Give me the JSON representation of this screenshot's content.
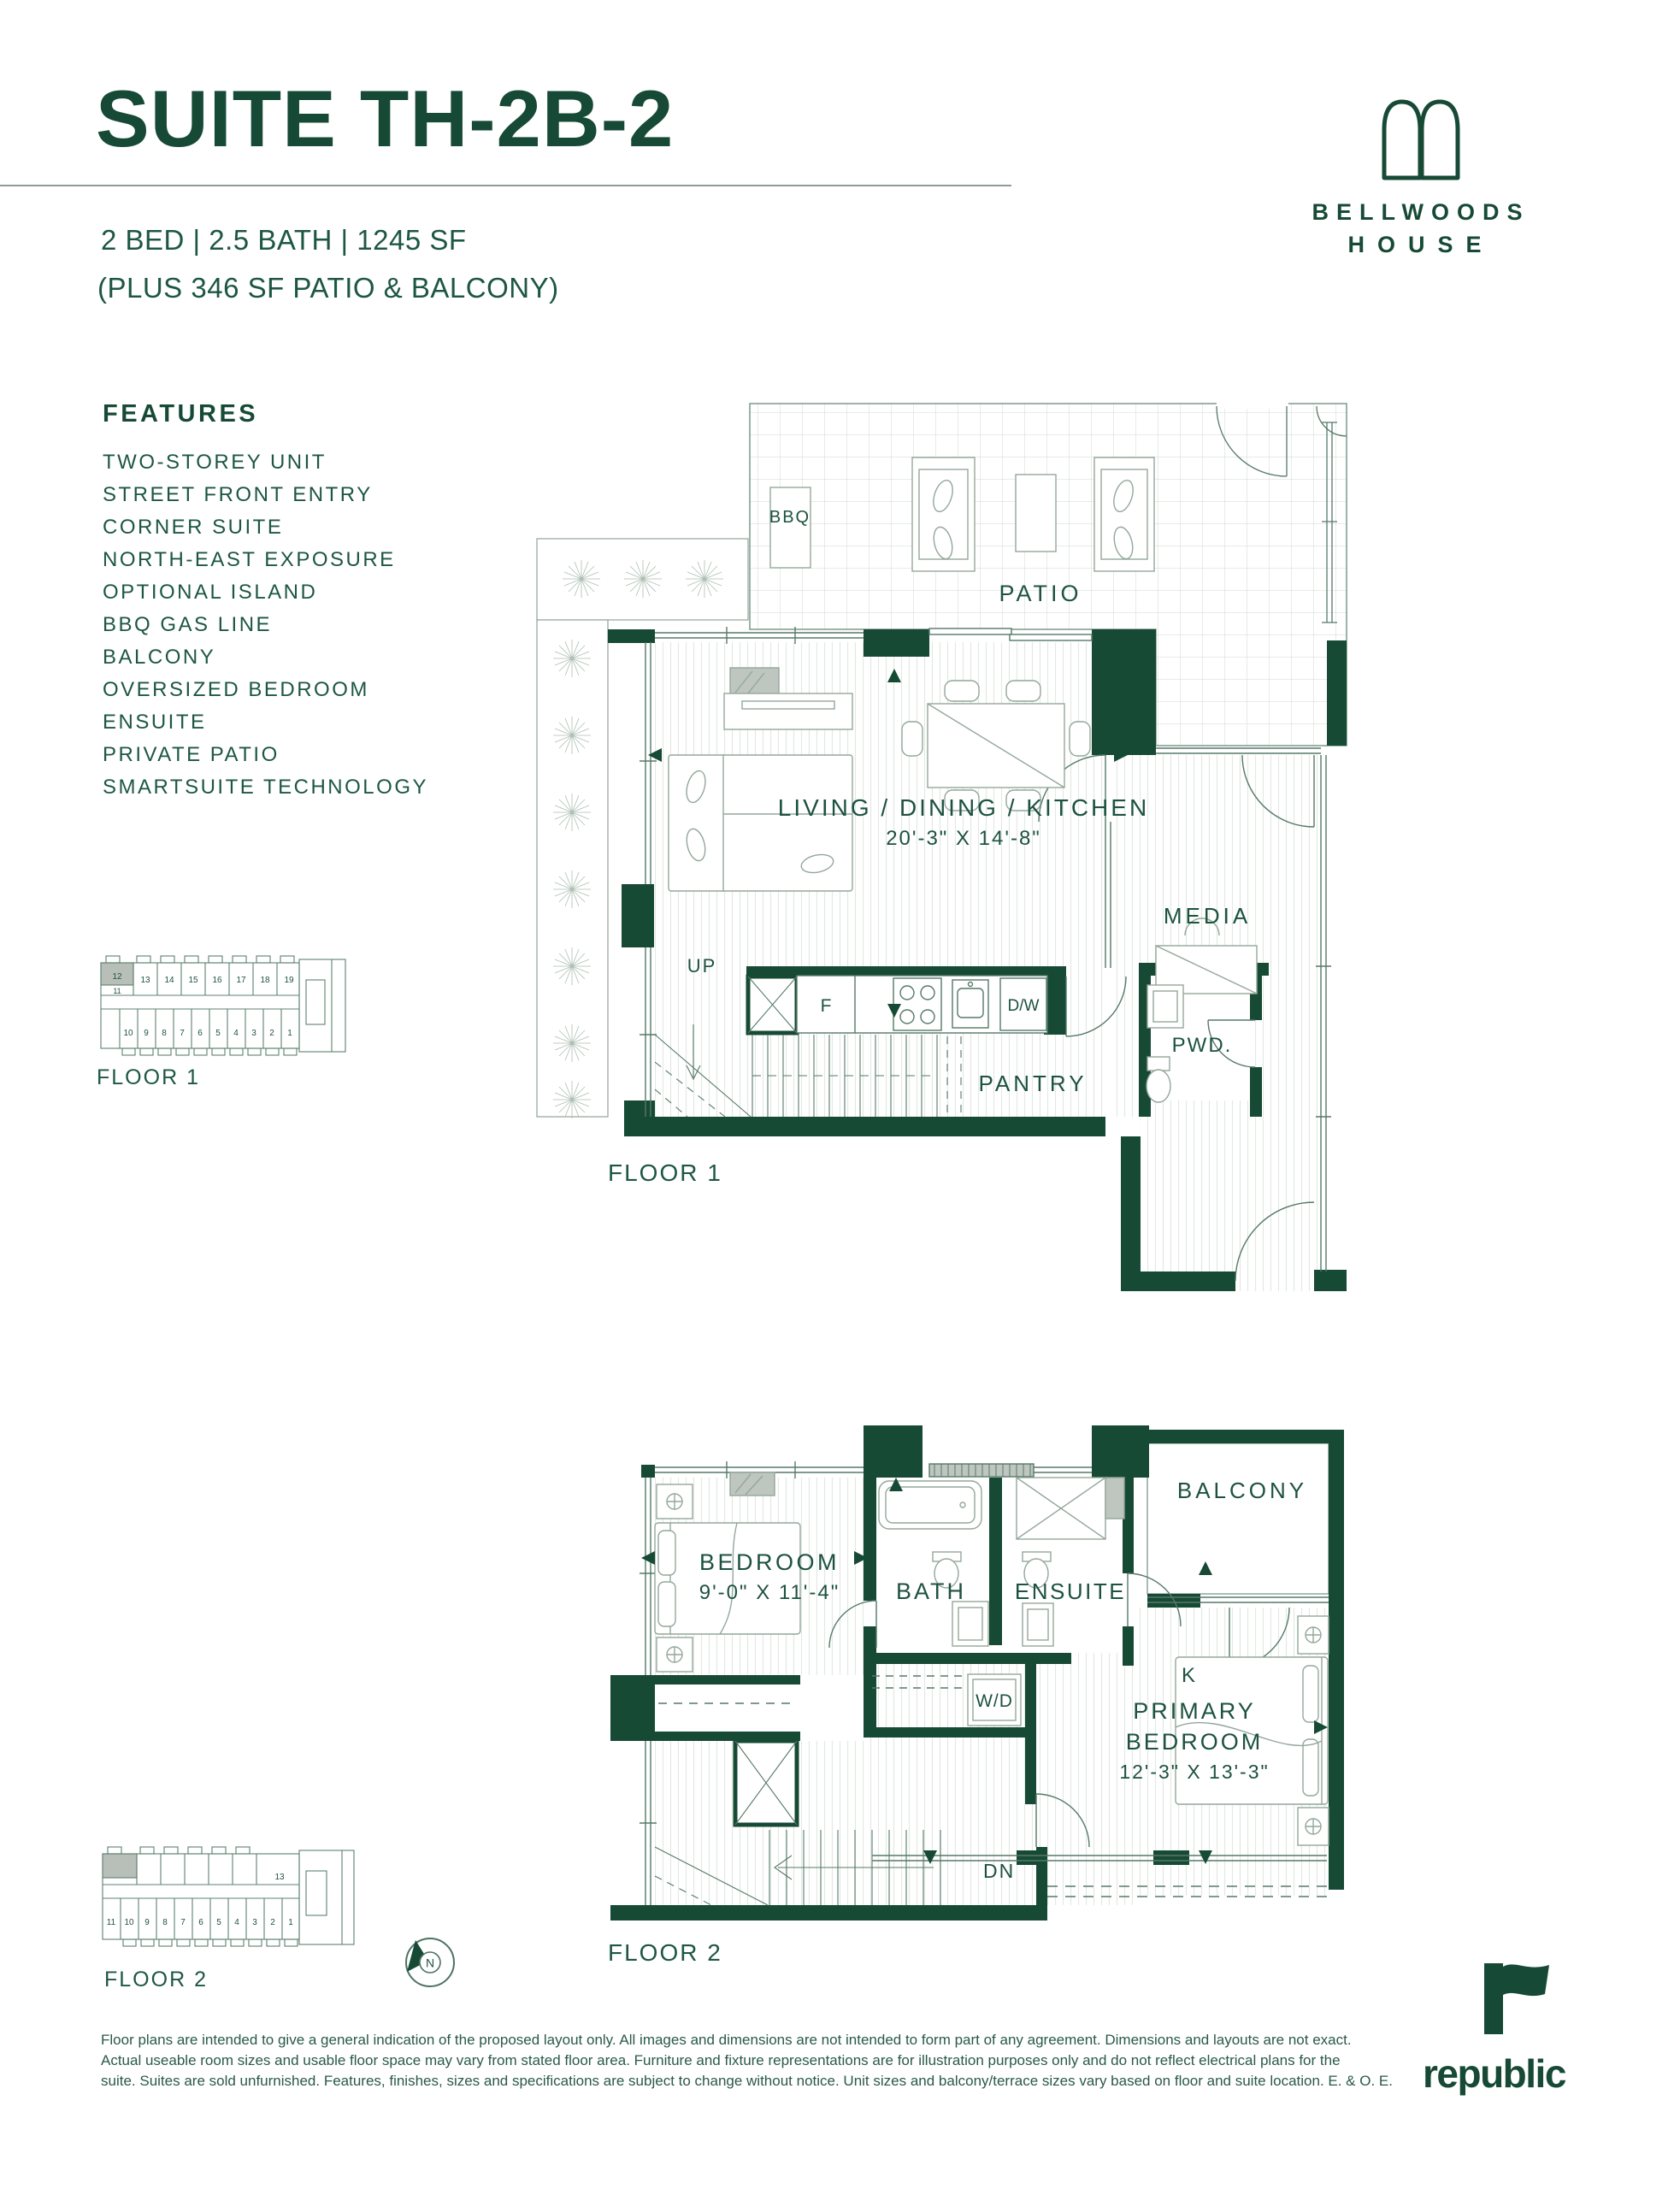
{
  "page": {
    "background": "#ffffff",
    "accent_green": "#174a35"
  },
  "header": {
    "suite_title": "SUITE TH-2B-2",
    "specs_line": "2 BED | 2.5 BATH | 1245 SF",
    "specs_extra": "(PLUS 346 SF PATIO & BALCONY)"
  },
  "brand": {
    "logo_icon": "double-arch-icon",
    "line1": "BELLWOODS",
    "line2": "HOUSE"
  },
  "features": {
    "heading": "FEATURES",
    "items": [
      "TWO-STOREY UNIT",
      "STREET FRONT ENTRY",
      "CORNER SUITE",
      "NORTH-EAST EXPOSURE",
      "OPTIONAL ISLAND",
      "BBQ GAS LINE",
      "BALCONY",
      "OVERSIZED BEDROOM",
      "ENSUITE",
      "PRIVATE PATIO",
      "SMARTSUITE TECHNOLOGY"
    ]
  },
  "floor1": {
    "plan_label": "FLOOR 1",
    "key_label": "FLOOR 1",
    "rooms": {
      "patio": "PATIO",
      "bbq": "BBQ",
      "living": "LIVING / DINING / KITCHEN",
      "living_dims": "20'-3\" X 14'-8\"",
      "media": "MEDIA",
      "powder": "PWD.",
      "pantry": "PANTRY",
      "up": "UP",
      "fridge": "F",
      "dishwasher": "D/W"
    },
    "key_units_top": [
      "12",
      "13",
      "14",
      "15",
      "16",
      "17",
      "18",
      "19"
    ],
    "key_unit_mid": "11",
    "key_units_bottom": [
      "10",
      "9",
      "8",
      "7",
      "6",
      "5",
      "4",
      "3",
      "2",
      "1"
    ],
    "highlighted_unit": "12"
  },
  "floor2": {
    "plan_label": "FLOOR 2",
    "key_label": "FLOOR 2",
    "rooms": {
      "balcony": "BALCONY",
      "bedroom": "BEDROOM",
      "bedroom_dims": "9'-0\" X 11'-4\"",
      "bath": "BATH",
      "ensuite": "ENSUITE",
      "washer_dryer": "W/D",
      "king_bed": "K",
      "primary_line1": "PRIMARY",
      "primary_line2": "BEDROOM",
      "primary_dims": "12'-3\" X 13'-3\"",
      "down": "DN"
    },
    "key_units_top": [
      "13"
    ],
    "key_units_bottom": [
      "11",
      "10",
      "9",
      "8",
      "7",
      "6",
      "5",
      "4",
      "3",
      "2",
      "1"
    ]
  },
  "compass": {
    "north_label": "N"
  },
  "disclaimer": {
    "line1": "Floor plans are intended to give a general indication of the proposed layout only. All images and dimensions are not intended to form part of any agreement. Dimensions and layouts are not exact.",
    "line2": "Actual useable room sizes and usable floor space may vary from stated floor area. Furniture and fixture representations are for illustration purposes only and do not reflect electrical plans for the",
    "line3": "suite. Suites are sold unfurnished. Features, finishes, sizes and specifications are subject to change without notice. Unit sizes and balcony/terrace sizes vary based on floor and suite location. E. & O. E."
  },
  "developer": {
    "wordmark": "republic",
    "logo_icon": "republic-flag-icon"
  }
}
